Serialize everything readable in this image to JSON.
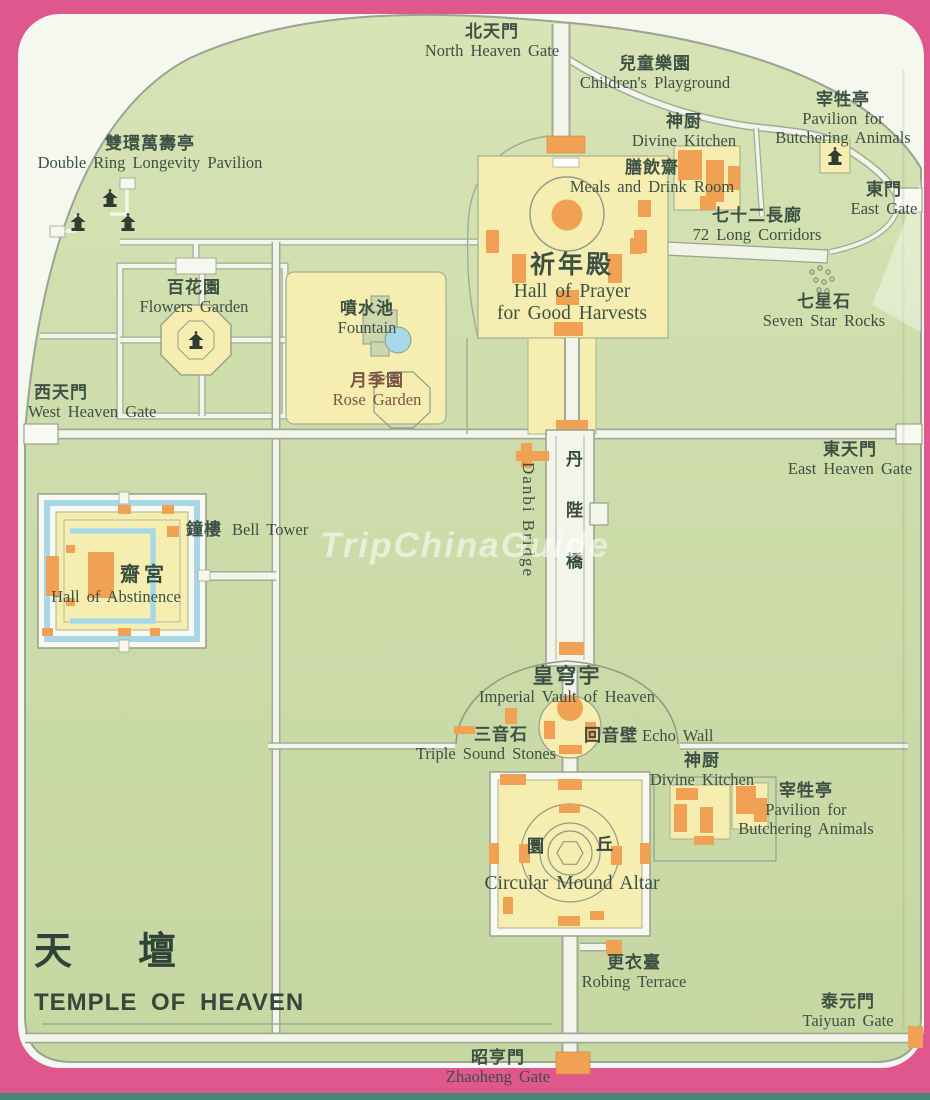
{
  "title": {
    "zh": "天　壇",
    "en": "TEMPLE OF HEAVEN"
  },
  "watermark": "TripChinaGuide",
  "colors": {
    "border_pink": "#e0578d",
    "park_green": "#cbdaa6",
    "compound_yellow": "#f5eeb0",
    "building_orange": "#f0a153",
    "water_blue": "#a8d8e8",
    "road_white": "#f3f4ea",
    "label_text": "#3c5144"
  },
  "labels": {
    "north_heaven_gate": {
      "zh": "北天門",
      "en": "North Heaven Gate"
    },
    "childrens_playground": {
      "zh": "兒童樂園",
      "en": "Children's Playground"
    },
    "pavilion_butchering_top": {
      "zh": "宰牲亭",
      "en1": "Pavilion for",
      "en2": "Butchering Animals"
    },
    "divine_kitchen_top": {
      "zh": "神厨",
      "en": "Divine Kitchen"
    },
    "meals_drink_room": {
      "zh": "膳飲齋",
      "en": "Meals and Drink Room"
    },
    "long_corridors": {
      "zh": "七十二長廊",
      "en": "72 Long Corridors"
    },
    "east_gate": {
      "zh": "東門",
      "en": "East Gate"
    },
    "double_ring_pavilion": {
      "zh": "雙環萬壽亭",
      "en": "Double Ring Longevity Pavilion"
    },
    "flowers_garden": {
      "zh": "百花園",
      "en": "Flowers Garden"
    },
    "fountain": {
      "zh": "噴水池",
      "en": "Fountain"
    },
    "rose_garden": {
      "zh": "月季園",
      "en": "Rose Garden"
    },
    "west_heaven_gate": {
      "zh": "西天門",
      "en": "West Heaven Gate"
    },
    "hall_of_prayer": {
      "zh": "祈年殿",
      "en1": "Hall of Prayer",
      "en2": "for Good Harvests"
    },
    "seven_star_rocks": {
      "zh": "七星石",
      "en": "Seven Star Rocks"
    },
    "east_heaven_gate": {
      "zh": "東天門",
      "en": "East Heaven Gate"
    },
    "bell_tower": {
      "zh": "鐘樓",
      "en": "Bell Tower"
    },
    "hall_of_abstinence": {
      "zh": "齋宮",
      "en": "Hall of Abstinence"
    },
    "danbi_bridge": {
      "zh": "丹陛橋",
      "en": "Danbi Bridge"
    },
    "imperial_vault": {
      "zh": "皇穹宇",
      "en": "Imperial Vault of Heaven"
    },
    "triple_sound_stones": {
      "zh": "三音石",
      "en": "Triple Sound Stones"
    },
    "echo_wall": {
      "zh": "回音壁",
      "en": "Echo Wall"
    },
    "divine_kitchen_bottom": {
      "zh": "神厨",
      "en": "Divine Kitchen"
    },
    "pavilion_butchering_bottom": {
      "zh": "宰牲亭",
      "en1": "Pavilion for",
      "en2": "Butchering Animals"
    },
    "circular_mound": {
      "zh1": "圜",
      "zh2": "丘",
      "en": "Circular Mound Altar"
    },
    "robing_terrace": {
      "zh": "更衣臺",
      "en": "Robing Terrace"
    },
    "taiyuan_gate": {
      "zh": "泰元門",
      "en": "Taiyuan Gate"
    },
    "zhaoheng_gate": {
      "zh": "昭亨門",
      "en": "Zhaoheng Gate"
    }
  }
}
